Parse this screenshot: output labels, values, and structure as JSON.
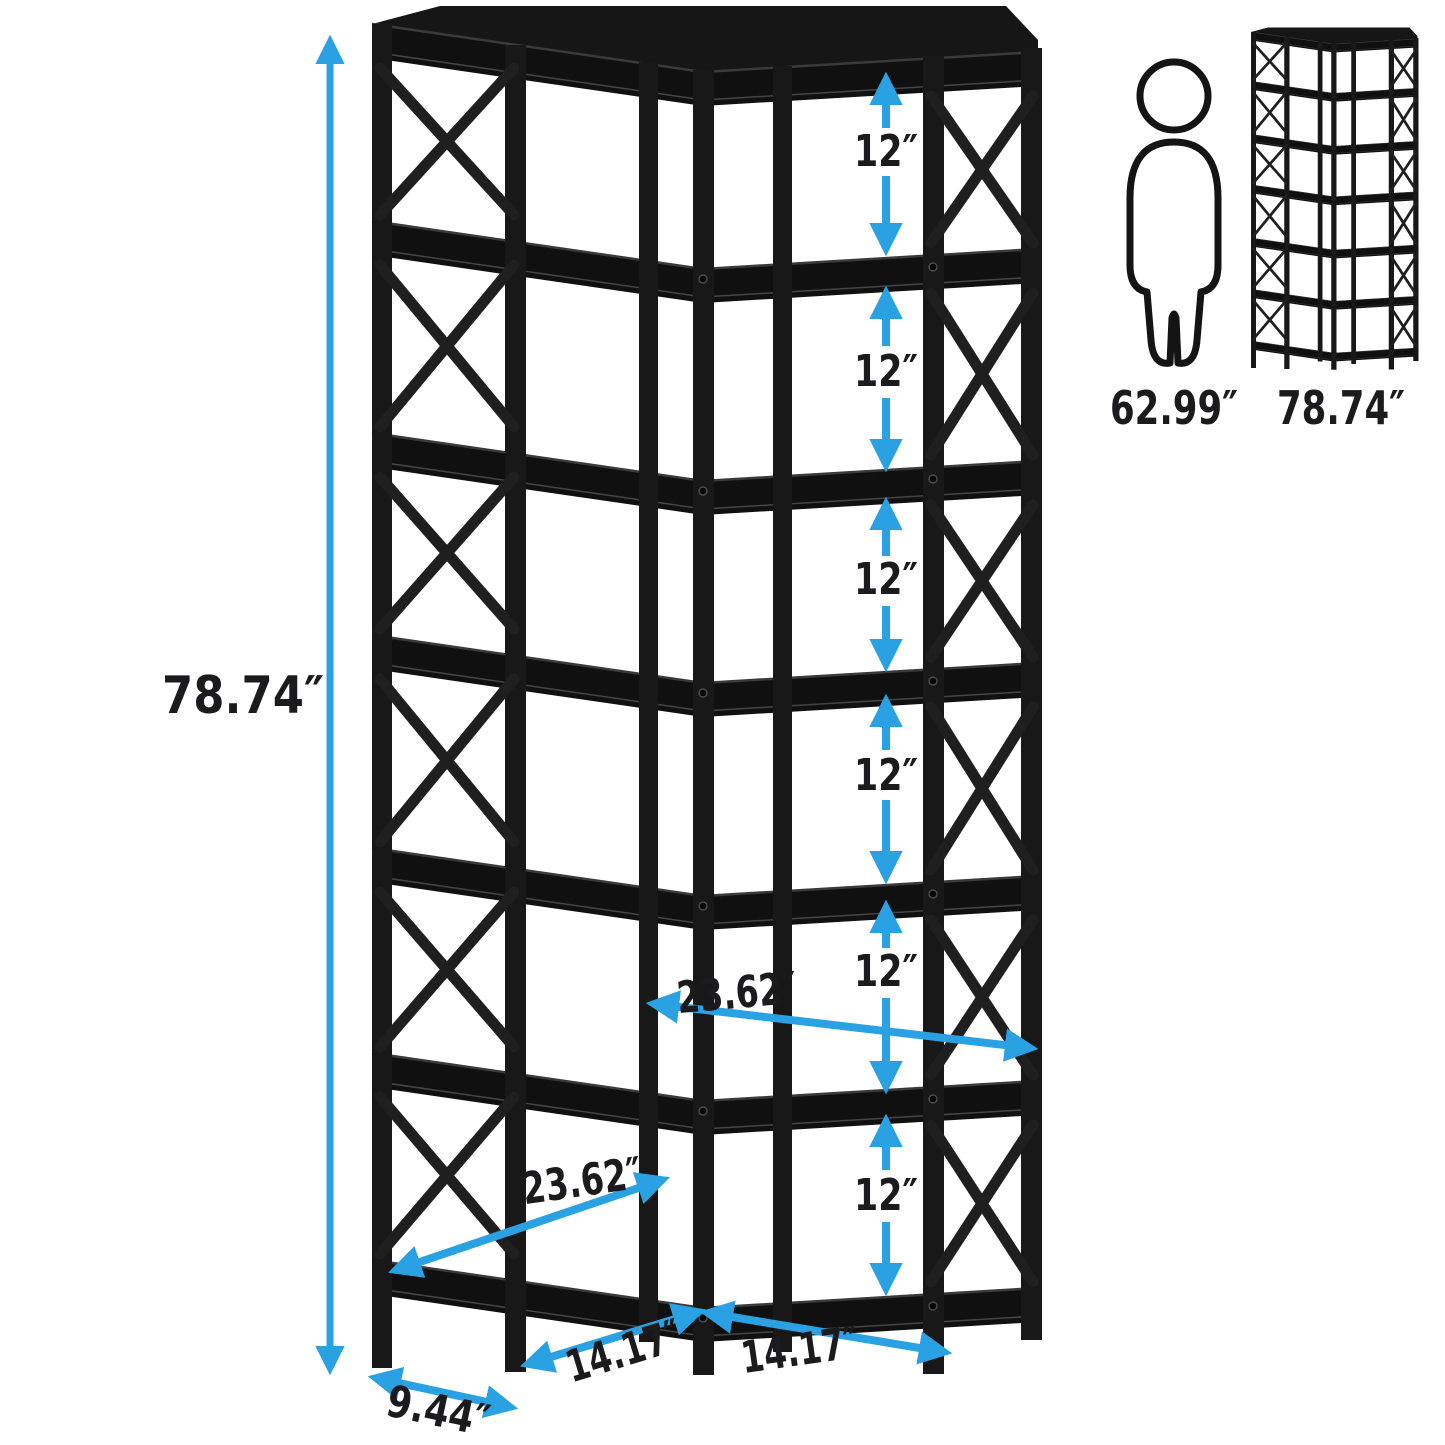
{
  "page": {
    "background": "#ffffff"
  },
  "palette": {
    "arrow_blue": "#2AA1E3",
    "label_text": "#1b1b1d",
    "shelf_black": "#101010"
  },
  "labels": {
    "total_height": "78.74″",
    "tier_gaps": [
      "12″",
      "12″",
      "12″",
      "12″",
      "12″",
      "12″"
    ],
    "shelf_width_right": "23.62″",
    "shelf_width_left": "23.62″",
    "base_width_left": "14.17″",
    "base_width_right": "14.17″",
    "base_depth": "9.44″"
  },
  "size_reference": {
    "person_height": "62.99″",
    "bookshelf_height": "78.74″"
  }
}
